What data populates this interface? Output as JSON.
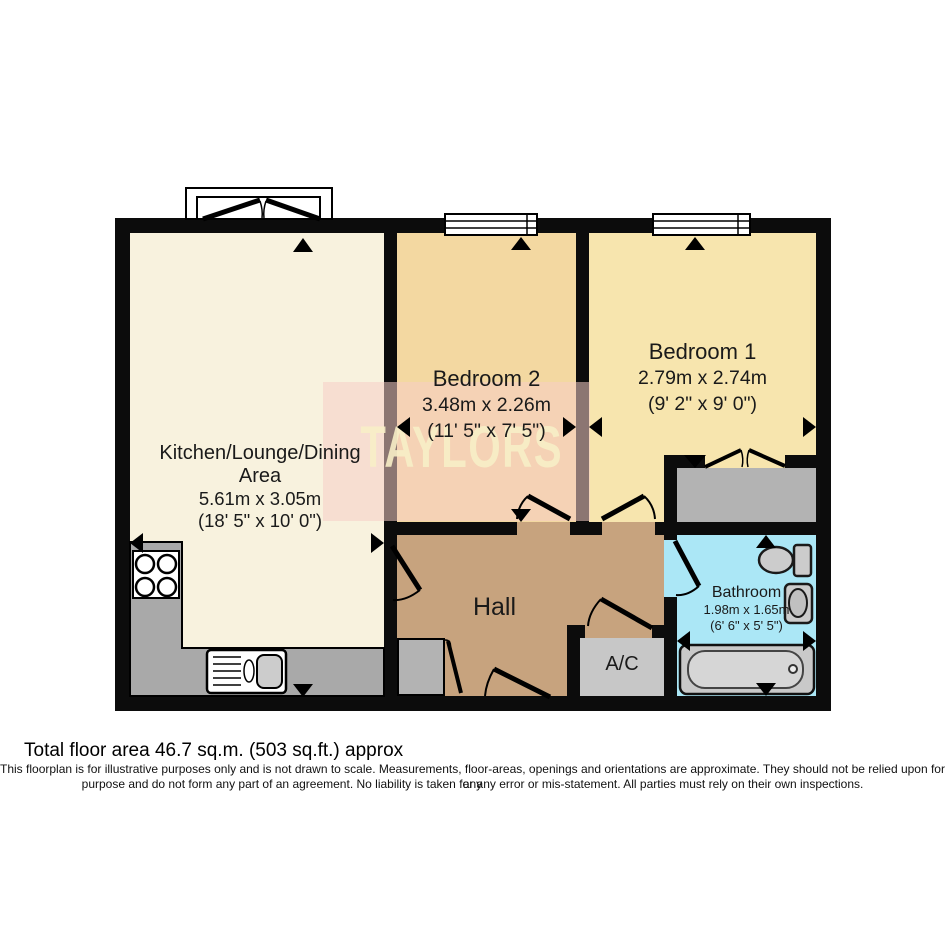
{
  "watermark": {
    "text": "TAYLORS"
  },
  "rooms": {
    "kitchen": {
      "name": "Kitchen/Lounge/Dining Area",
      "dims_metric": "5.61m x 3.05m",
      "dims_imperial": "(18' 5\" x 10' 0\")"
    },
    "bedroom2": {
      "name": "Bedroom 2",
      "dims_metric": "3.48m x 2.26m",
      "dims_imperial": "(11' 5\" x 7' 5\")"
    },
    "bedroom1": {
      "name": "Bedroom 1",
      "dims_metric": "2.79m x 2.74m",
      "dims_imperial": "(9' 2\" x 9' 0\")"
    },
    "hall": {
      "name": "Hall"
    },
    "bathroom": {
      "name": "Bathroom",
      "dims_metric": "1.98m x 1.65m",
      "dims_imperial": "(6' 6\" x 5' 5\")"
    },
    "airing_cupboard": {
      "name": "A/C"
    }
  },
  "footer": {
    "total_area": "Total floor area 46.7 sq.m. (503 sq.ft.) approx",
    "disclaimer_line1": "This floorplan is for illustrative purposes only and is not drawn to scale. Measurements, floor-areas, openings and orientations are approximate. They should not be relied upon for any",
    "disclaimer_line2": "purpose and do not form any part of an agreement. No liability is taken for any error or mis-statement. All parties must rely on their own inspections."
  },
  "colors": {
    "wall": "#0c0c0c",
    "kitchen": "#f8f2de",
    "bedroom2": "#f3d8a1",
    "bedroom1": "#f7e5ae",
    "hall": "#c7a37e",
    "bathroom": "#abe7f6",
    "fixture_gray": "#b3b3b3",
    "ac_gray": "#c7c7c7",
    "counter_gray": "#a9a9a9",
    "watermark_bg": "rgba(246,205,199,0.55)",
    "watermark_text": "rgba(247,238,199,0.9)"
  }
}
